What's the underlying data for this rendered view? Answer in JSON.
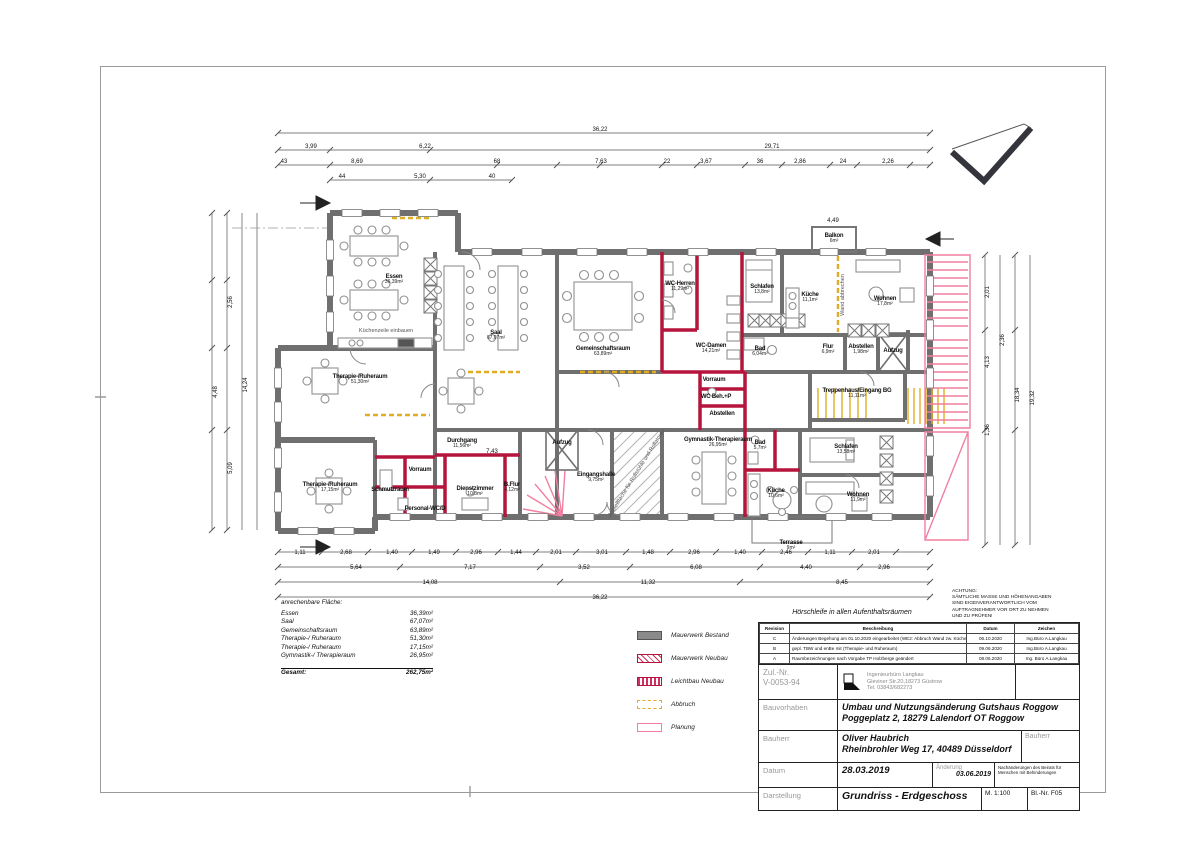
{
  "plan": {
    "rooms": [
      {
        "name": "Essen",
        "area": "36,39m²",
        "x": 394,
        "y": 280
      },
      {
        "name": "Saal",
        "area": "67,07m²",
        "x": 496,
        "y": 336
      },
      {
        "name": "Gemeinschaftsraum",
        "area": "63,89m²",
        "x": 603,
        "y": 352
      },
      {
        "name": "WC-Herren",
        "area": "11,29m²",
        "x": 680,
        "y": 287
      },
      {
        "name": "WC-Damen",
        "area": "14,21m²",
        "x": 711,
        "y": 349
      },
      {
        "name": "Schlafen",
        "area": "13,8m²",
        "x": 762,
        "y": 290
      },
      {
        "name": "Küche",
        "area": "11,1m²",
        "x": 810,
        "y": 298
      },
      {
        "name": "Wohnen",
        "area": "17,8m²",
        "x": 885,
        "y": 302
      },
      {
        "name": "Bad",
        "area": "6,04m²",
        "x": 760,
        "y": 352
      },
      {
        "name": "Flur",
        "area": "6,9m²",
        "x": 828,
        "y": 350
      },
      {
        "name": "Abstellen",
        "area": "1,98m²",
        "x": 861,
        "y": 350
      },
      {
        "name": "Aufzug",
        "area": "",
        "x": 893,
        "y": 351
      },
      {
        "name": "Balkon",
        "area": "6m²",
        "x": 834,
        "y": 239
      },
      {
        "name": "Treppenhaus/Eingang BG",
        "area": "11,11m²",
        "x": 857,
        "y": 394
      },
      {
        "name": "Vorraum",
        "area": "",
        "x": 714,
        "y": 380
      },
      {
        "name": "WC Beh.+P",
        "area": "",
        "x": 716,
        "y": 397
      },
      {
        "name": "Abstellen",
        "area": "",
        "x": 722,
        "y": 414
      },
      {
        "name": "Therapie-/Ruheraum",
        "area": "51,30m²",
        "x": 360,
        "y": 380
      },
      {
        "name": "Therapie-/Ruheraum",
        "area": "17,15m²",
        "x": 330,
        "y": 488
      },
      {
        "name": "Durchgang",
        "area": "11,56m²",
        "x": 462,
        "y": 444
      },
      {
        "name": "Vorraum",
        "area": "",
        "x": 420,
        "y": 470
      },
      {
        "name": "Schmutzraum",
        "area": "",
        "x": 390,
        "y": 490
      },
      {
        "name": "Personal-WC/D",
        "area": "",
        "x": 425,
        "y": 509
      },
      {
        "name": "Dienstzimmer",
        "area": "10,8m²",
        "x": 475,
        "y": 492
      },
      {
        "name": "B.Flur",
        "area": "4,12m²",
        "x": 512,
        "y": 488
      },
      {
        "name": "Aufzug",
        "area": "",
        "x": 562,
        "y": 443
      },
      {
        "name": "Eingangshalle",
        "area": "9,75m²",
        "x": 596,
        "y": 478
      },
      {
        "name": "Gymnastik-Therapieraum",
        "area": "26,95m²",
        "x": 718,
        "y": 443
      },
      {
        "name": "Bad",
        "area": "5,7m²",
        "x": 760,
        "y": 446
      },
      {
        "name": "Küche",
        "area": "10,6m²",
        "x": 776,
        "y": 494
      },
      {
        "name": "Schlafen",
        "area": "13,58m²",
        "x": 846,
        "y": 450
      },
      {
        "name": "Wohnen",
        "area": "11,9m²",
        "x": 858,
        "y": 498
      },
      {
        "name": "Terrasse",
        "area": "9m²",
        "x": 791,
        "y": 546
      }
    ],
    "annotations": [
      {
        "text": "Küchenzeile einbauen",
        "x": 386,
        "y": 331,
        "rot": 0
      },
      {
        "text": "Wand abbrechen",
        "x": 843,
        "y": 295,
        "rot": -90
      },
      {
        "text": "Abstellfläche für Rollstühle und Rollatoren",
        "x": 637,
        "y": 473,
        "rot": -58
      }
    ],
    "dims": [
      {
        "t": "36,22",
        "x": 600,
        "y": 130
      },
      {
        "t": "3,99",
        "x": 311,
        "y": 147
      },
      {
        "t": "6,22",
        "x": 425,
        "y": 147
      },
      {
        "t": "29,71",
        "x": 772,
        "y": 147
      },
      {
        "t": "43",
        "x": 284,
        "y": 162
      },
      {
        "t": "8,69",
        "x": 357,
        "y": 162
      },
      {
        "t": "68",
        "x": 497,
        "y": 162
      },
      {
        "t": "7,63",
        "x": 601,
        "y": 162
      },
      {
        "t": "22",
        "x": 667,
        "y": 162
      },
      {
        "t": "3,67",
        "x": 706,
        "y": 162
      },
      {
        "t": "36",
        "x": 760,
        "y": 162
      },
      {
        "t": "2,86",
        "x": 800,
        "y": 162
      },
      {
        "t": "24",
        "x": 843,
        "y": 162
      },
      {
        "t": "2,26",
        "x": 888,
        "y": 162
      },
      {
        "t": "44",
        "x": 342,
        "y": 177
      },
      {
        "t": "5,30",
        "x": 420,
        "y": 177
      },
      {
        "t": "40",
        "x": 492,
        "y": 177
      },
      {
        "t": "4,49",
        "x": 833,
        "y": 221
      },
      {
        "t": "7,43",
        "x": 492,
        "y": 452
      },
      {
        "t": "1,11",
        "x": 300,
        "y": 553
      },
      {
        "t": "2,68",
        "x": 346,
        "y": 553
      },
      {
        "t": "1,40",
        "x": 392,
        "y": 553
      },
      {
        "t": "1,49",
        "x": 434,
        "y": 553
      },
      {
        "t": "2,96",
        "x": 476,
        "y": 553
      },
      {
        "t": "1,44",
        "x": 516,
        "y": 553
      },
      {
        "t": "2,01",
        "x": 556,
        "y": 553
      },
      {
        "t": "3,01",
        "x": 602,
        "y": 553
      },
      {
        "t": "1,48",
        "x": 648,
        "y": 553
      },
      {
        "t": "2,96",
        "x": 694,
        "y": 553
      },
      {
        "t": "1,40",
        "x": 740,
        "y": 553
      },
      {
        "t": "2,46",
        "x": 786,
        "y": 553
      },
      {
        "t": "1,11",
        "x": 830,
        "y": 553
      },
      {
        "t": "2,01",
        "x": 874,
        "y": 553
      },
      {
        "t": "5,64",
        "x": 356,
        "y": 568
      },
      {
        "t": "7,17",
        "x": 470,
        "y": 568
      },
      {
        "t": "3,52",
        "x": 584,
        "y": 568
      },
      {
        "t": "6,08",
        "x": 696,
        "y": 568
      },
      {
        "t": "4,40",
        "x": 806,
        "y": 568
      },
      {
        "t": "2,96",
        "x": 884,
        "y": 568
      },
      {
        "t": "14,08",
        "x": 430,
        "y": 583
      },
      {
        "t": "11,32",
        "x": 648,
        "y": 583
      },
      {
        "t": "8,45",
        "x": 842,
        "y": 583
      },
      {
        "t": "36,22",
        "x": 600,
        "y": 598
      },
      {
        "t": "4,48",
        "x": 216,
        "y": 392,
        "r": -90
      },
      {
        "t": "2,56",
        "x": 231,
        "y": 302,
        "r": -90
      },
      {
        "t": "5,09",
        "x": 231,
        "y": 468,
        "r": -90
      },
      {
        "t": "14,24",
        "x": 246,
        "y": 385,
        "r": -90
      },
      {
        "t": "2,01",
        "x": 988,
        "y": 292,
        "r": -90
      },
      {
        "t": "4,13",
        "x": 988,
        "y": 362,
        "r": -90
      },
      {
        "t": "1,36",
        "x": 988,
        "y": 430,
        "r": -90
      },
      {
        "t": "2,36",
        "x": 1003,
        "y": 340,
        "r": -90
      },
      {
        "t": "18,34",
        "x": 1018,
        "y": 395,
        "r": -90
      },
      {
        "t": "19,32",
        "x": 1033,
        "y": 398,
        "r": -90
      }
    ]
  },
  "area_table": {
    "title": "anrechenbare Fläche:",
    "rows": [
      [
        "Essen",
        "36,39m²"
      ],
      [
        "Saal",
        "67,07m²"
      ],
      [
        "Gemeinschaftsraum",
        "63,89m²"
      ],
      [
        "Therapie-/ Ruheraum",
        "51,30m²"
      ],
      [
        "Therapie-/ Ruheraum",
        "17,15m²"
      ],
      [
        "Gymnastik-/ Therapieraum",
        "26,95m²"
      ]
    ],
    "total_label": "Gesamt:",
    "total_value": "262,75m²"
  },
  "legend": {
    "items": [
      {
        "label": "Mauerwerk Bestand",
        "type": "solid-gray"
      },
      {
        "label": "Mauerwerk Neubau",
        "type": "hatch-red"
      },
      {
        "label": "Leichtbau Neubau",
        "type": "dense-red"
      },
      {
        "label": "Abbruch",
        "type": "dashed-yellow"
      },
      {
        "label": "Planung",
        "type": "outline-pink"
      }
    ]
  },
  "notes": {
    "hoerschleife": "Hörschleife in allen Aufenthaltsräumen",
    "achtung": [
      "ACHTUNG:",
      "SÄMTLICHE MASSE UND HÖHENANGABEN",
      "SIND EIGENVERANTWORTLICH VOM",
      "AUFTRAGNEHMER VOR ORT ZU NEHMEN",
      "UND ZU PRÜFEN!"
    ]
  },
  "titleblock": {
    "rev_header": {
      "revision": "Revision",
      "beschreibung": "Beschreibung",
      "datum": "Datum",
      "zeichen": "Zeichen"
    },
    "revisions": [
      {
        "rev": "C",
        "desc": "Änderungen Begehung am 01.10.2020 eingearbeitet (WE2: Abbruch Wand zw. Küche /Wohnen)",
        "date": "06.10.2020",
        "sign": "Ing.Büro A.Langkau"
      },
      {
        "rev": "B",
        "desc": "gepl. TBW und enBe mit (Therapie- und Ruheraum)",
        "date": "09.06.2020",
        "sign": "Ing.Büro A.Langkau"
      },
      {
        "rev": "A",
        "desc": "Raumbezeichnungen nach Vorgabe TP Holzberge geändert",
        "date": "08.06.2020",
        "sign": "Ing. Büro A.Langkau"
      }
    ],
    "zul_label": "Zul.-Nr.",
    "zul_value": "V-0053-94",
    "firm_line1": "Ingenieurbüro Langkau",
    "firm_line2": "Gleviner Str.20,18273 Güstrow",
    "firm_line3": "Tel. 03843/682273",
    "bauvorhaben_label": "Bauvorhaben",
    "bauvorhaben_line1": "Umbau und Nutzungsänderung Gutshaus Roggow",
    "bauvorhaben_line2": "Poggeplatz 2, 18279 Lalendorf OT Roggow",
    "bauherr_label": "Bauherr",
    "bauherr_line1": "Oliver Haubrich",
    "bauherr_line2": "Rheinbrohler Weg 17, 40489 Düsseldorf",
    "bauherr_label2": "Bauherr",
    "datum_label": "Datum",
    "datum_value": "28.03.2019",
    "aenderung_label": "Änderung",
    "aenderung_value": "03.06.2019",
    "beirat_note": "Nachänderungen des Beirats für Menschen mit Behinderungen",
    "darstellung_label": "Darstellung",
    "darstellung_value": "Grundriss - Erdgeschoss",
    "massstab": "M. 1:100",
    "blatt": "Bl.-Nr. F05"
  }
}
